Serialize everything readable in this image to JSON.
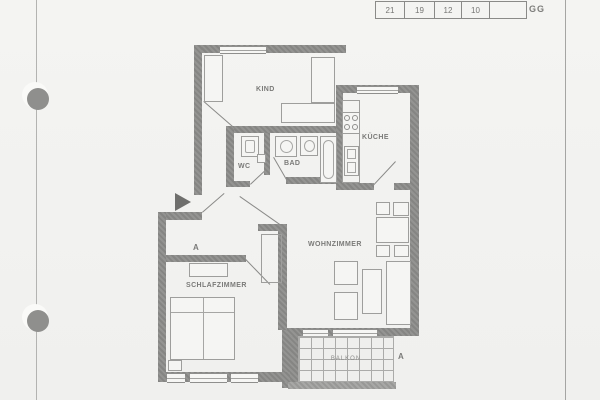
{
  "header": {
    "cells": [
      "21",
      "19",
      "12",
      "10",
      ""
    ],
    "code": "GG"
  },
  "rooms": {
    "kind": "KIND",
    "kueche": "KÜCHE",
    "wc": "WC",
    "bad": "BAD",
    "wohnzimmer": "WOHNZIMMER",
    "schlafzimmer": "SCHLAFZIMMER",
    "balkon": "BALKON"
  },
  "markers": {
    "section_top": "A",
    "section_right": "A"
  },
  "colors": {
    "paper": "#f3f3f1",
    "wall": "#8c8c8a",
    "line": "#9a9a98",
    "label": "#7a7a78"
  }
}
